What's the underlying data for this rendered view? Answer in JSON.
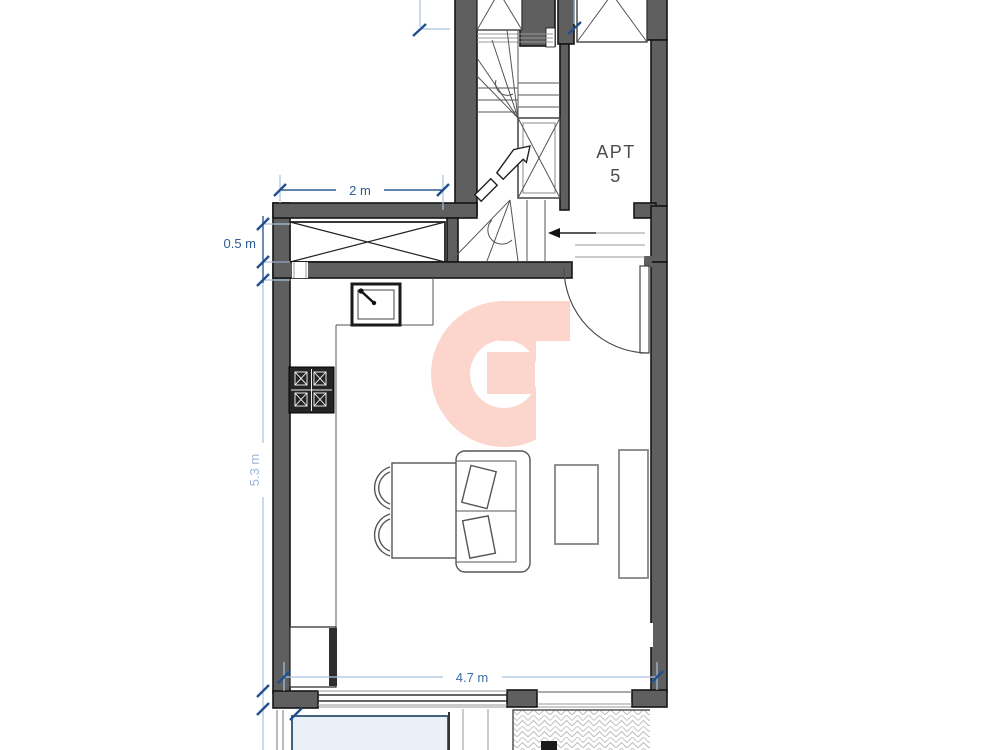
{
  "plan": {
    "apartment_label": {
      "line1": "APT",
      "line2": "5"
    },
    "dimensions": {
      "top_width": "2 m",
      "left_small": "0.5 m",
      "left_height": "5.3 m",
      "bottom_width": "4.7 m"
    },
    "features": [
      "staircase",
      "void-shaft",
      "duct-box",
      "apartment-corridor",
      "kitchen-sink",
      "stove",
      "kitchen-counter",
      "tall-cabinet",
      "dining-table",
      "dining-chairs",
      "sofa",
      "coffee-table",
      "sideboard",
      "entrance-door-swing",
      "sliding-glass-wall",
      "pool",
      "paved-terrace",
      "logo-watermark"
    ],
    "colors": {
      "wall_gray": "#5f5f5f",
      "line_dark": "#161616",
      "dimension_dark_blue": "#2d5c95",
      "dimension_light_blue": "#aac2de",
      "dimension_light_text": "#9cb8d6",
      "apartment_text": "#4d4d4d",
      "logo_pink": "#fcd6cd",
      "pool_fill": "#e9f0f8",
      "pool_border": "#44607f",
      "hatch_line": "#bdbdbd"
    }
  }
}
